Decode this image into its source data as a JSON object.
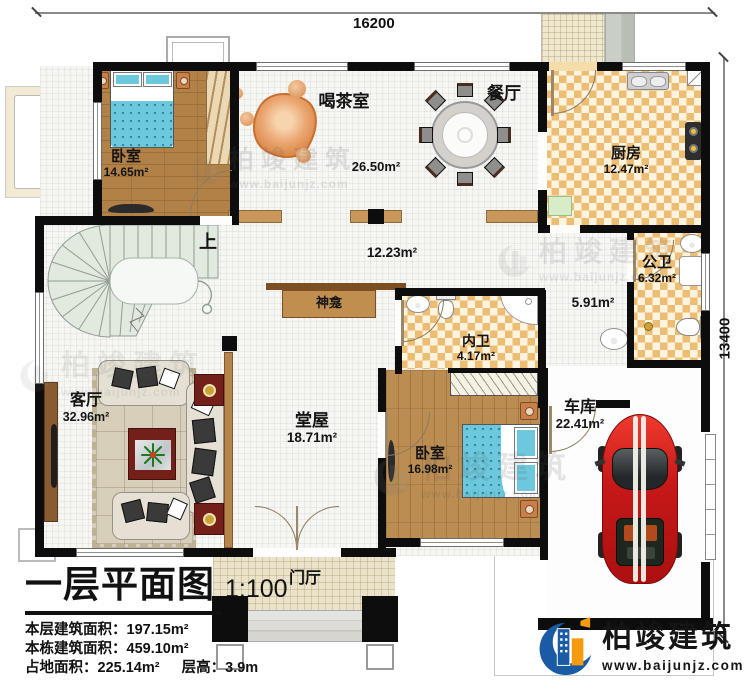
{
  "dimensions": {
    "width_label": "16200",
    "height_label": "13400"
  },
  "rooms": {
    "bedroom1": {
      "name": "卧室",
      "area": "14.65m²"
    },
    "tea_room": {
      "name": "喝茶室",
      "area": "26.50m²"
    },
    "dining": {
      "name": "餐厅"
    },
    "kitchen": {
      "name": "厨房",
      "area": "12.47m²"
    },
    "public_bath": {
      "name": "公卫",
      "area": "6.32m²"
    },
    "corridor": {
      "area": "5.91m²"
    },
    "inner_bath": {
      "name": "内卫",
      "area": "4.17m²"
    },
    "bedroom2": {
      "name": "卧室",
      "area": "16.98m²"
    },
    "garage": {
      "name": "车库",
      "area": "22.41m²"
    },
    "living_room": {
      "name": "客厅",
      "area": "32.96m²"
    },
    "main_hall": {
      "name": "堂屋",
      "area": "18.71m²"
    },
    "foyer": {
      "name": "门厅"
    },
    "open_hall": {
      "area": "12.23m²"
    }
  },
  "annotations": {
    "shrine": "神龛",
    "stairs_up": "上"
  },
  "title_block": {
    "title": "一层平面图",
    "scale": "1:100",
    "floor_area_label": "本层建筑面积：",
    "floor_area_value": "197.15m²",
    "building_area_label": "本栋建筑面积：",
    "building_area_value": "459.10m²",
    "footprint_label": "占地面积：",
    "footprint_value": "225.14m²",
    "storey_height_label": "层高：",
    "storey_height_value": "3.9m"
  },
  "branding": {
    "company": "柏竣建筑",
    "website": "www.baijunjz.com"
  },
  "watermark": {
    "company": "柏竣建筑",
    "website": "www.baijunjz.com"
  },
  "colors": {
    "wall": "#0d0d0d",
    "wood_floor": "#b28147",
    "checker_tile": "#ecbd72",
    "bed": "#6cc8dc",
    "car": "#cf1d1d",
    "logo_blue": "#1b5aa5",
    "logo_orange": "#f59c0e"
  }
}
